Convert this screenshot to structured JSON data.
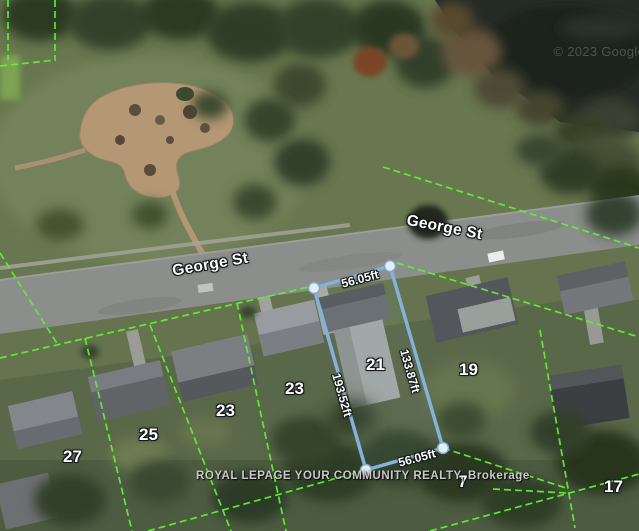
{
  "map": {
    "attribution": "© 2023 Google",
    "watermark": "ROYAL LEPAGE YOUR COMMUNITY REALTY, Brokerage",
    "street_labels": [
      {
        "text": "George St"
      },
      {
        "text": "George St"
      }
    ],
    "highlighted_parcel": {
      "lot_number": "21",
      "outline_color": "#85b2d8",
      "handle_fill": "#e4eef7",
      "dimensions": {
        "top": "56.05ft",
        "right": "133.87ft",
        "bottom": "56.05ft",
        "left": "193.52ft"
      }
    },
    "parcel_line_color": "#5df231",
    "lot_numbers": [
      {
        "label": "21"
      },
      {
        "label": "19"
      },
      {
        "label": "23"
      },
      {
        "label": "23"
      },
      {
        "label": "25"
      },
      {
        "label": "27"
      },
      {
        "label": "7"
      },
      {
        "label": "17"
      }
    ]
  }
}
